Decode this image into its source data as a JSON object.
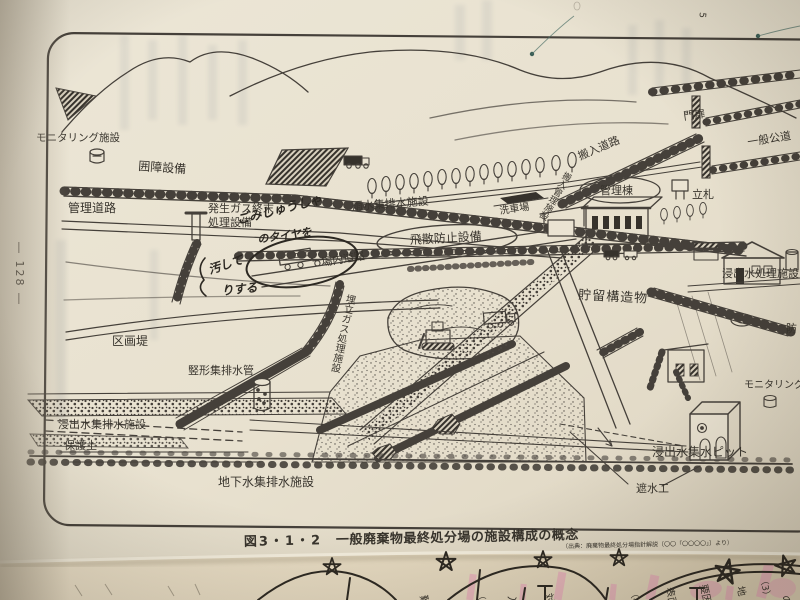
{
  "page": {
    "number_display": "― 128 ―",
    "top_mark": "5"
  },
  "caption": {
    "figure_no": "図3・1・2",
    "title": "一般廃棄物最終処分場の施設構成の概念",
    "source": "（出典：廃棄物最終処分場指針解説〔〇〇「〇〇〇〇」〕より）"
  },
  "labels": {
    "monitoring_left": "モニタリング施設",
    "enclosure": "囲障設備",
    "management_road": "管理道路",
    "gas_line1": "発生ガス終末",
    "gas_line2": "処理設備",
    "rainwater": "雨水集排水施設",
    "car_wash": "洗車場",
    "scatter": "飛散防止設備",
    "onsite_road": "場内道路",
    "carryin_road": "搬入道路",
    "gate": "門扉",
    "public_road": "一般公道",
    "sign": "立札",
    "admin": "管理棟",
    "carryin_mgmt": "搬入管理施設",
    "leachate_plant": "浸出水処理施設",
    "storage": "貯留構造物",
    "dike": "区画堤",
    "vertical_pipe": "竪形集排水管",
    "leachate_drain": "浸出水集排水施設",
    "soil": "保護土",
    "landfill_gas": "埋立ガス処理施設",
    "groundwater": "地下水集排水施設",
    "liner": "遮水工",
    "pit": "浸出水集水ピット",
    "monitoring_right": "モニタリング施設",
    "partial": "防"
  },
  "handwriting": {
    "line1": "ごみしゅうしゃ",
    "line2": "のタイヤを",
    "line3": "汚して",
    "line4": "りする"
  },
  "underlay": {
    "glyphs": [
      "難",
      "（5",
      "入",
      "対",
      "（4）",
      "表面",
      "要因",
      "地",
      "（3）",
      "の"
    ]
  },
  "colors": {
    "paper": "#eae3d2",
    "under_paper": "#e4d9c2",
    "ink": "#45403a",
    "pen": "#2c2822",
    "highlighter": "#e896b6",
    "photo_edge": "#a89e8c"
  }
}
